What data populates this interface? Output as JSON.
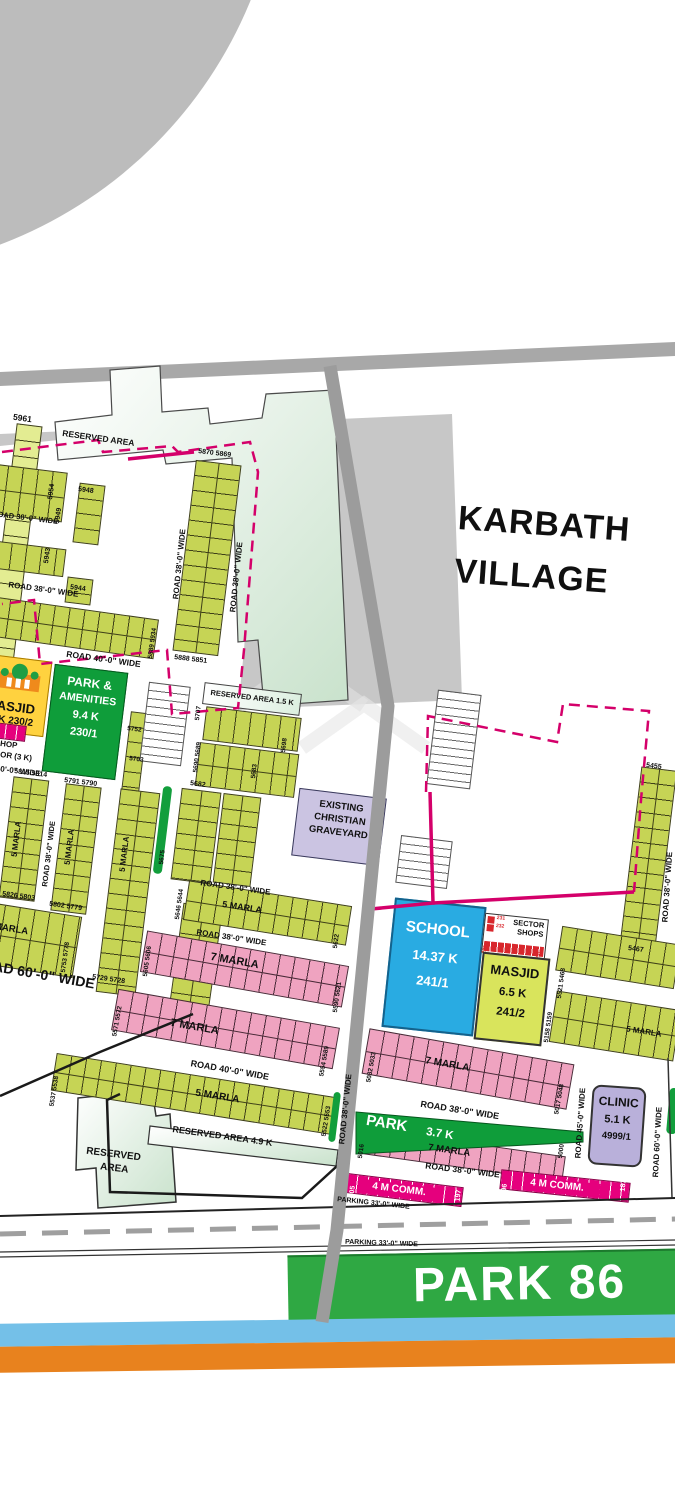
{
  "village": {
    "l1": "KARBATH",
    "l2": "VILLAGE"
  },
  "roads": {
    "r38": "ROAD 38'-0\" WIDE",
    "r40": "ROAD 40'-0\" WIDE",
    "r45": "ROAD 45'-0\" WIDE",
    "r60": "ROAD 60'-0\" WIDE",
    "parking": "PARKING 33'-0\" WIDE"
  },
  "marla": {
    "m5": "5 MARLA",
    "m7": "7 MARLA"
  },
  "comm": {
    "label": "4 M COMM."
  },
  "areas": {
    "reserved": "RESERVED AREA",
    "reserved15": "RESERVED AREA 1.5 K",
    "reserved49": "RESERVED AREA 4.9 K",
    "res_l1": "RESERVED",
    "res_l2": "AREA",
    "gy1": "EXISTING",
    "gy2": "CHRISTIAN",
    "gy3": "GRAVEYARD",
    "pa1": "PARK &",
    "pa2": "AMENITIES",
    "pa3": "9.4 K",
    "pa4": "230/1",
    "ml_name": "MASJID",
    "ml_detail": "K 230/2",
    "shop1": "HOP",
    "shop2": "OR (3 K)",
    "sch1": "SCHOOL",
    "sch2": "14.37 K",
    "sch3": "241/1",
    "ss1": "SECTOR",
    "ss2": "SHOPS",
    "mj1": "MASJID",
    "mj2": "6.5 K",
    "mj3": "241/2",
    "cl1": "CLINIC",
    "cl2": "5.1 K",
    "cl3": "4999/1",
    "p37n": "PARK",
    "p37s": "3.7 K",
    "park86": "PARK 86"
  },
  "plots": {
    "p5961": "5961",
    "p5954": "5954",
    "p5949": "5949",
    "p5948": "5948",
    "p5943": "5943",
    "p5944": "5944",
    "p5870": "5870 5869",
    "p5888": "5888 5851",
    "p5889": "5889 5934",
    "p5815": "5815 5814",
    "p5791": "5791 5790",
    "p5826": "5826 5803",
    "p5802": "5802 5779",
    "p5753": "5753 5778",
    "p5729": "5729 5728",
    "p5707": "5707",
    "p5690": "5690 5689",
    "p5698": "5698",
    "p5683": "5683",
    "p5682": "5682",
    "p5675": "5675",
    "p5752": "5752",
    "p5703": "5703",
    "p5646": "5646 5644",
    "p5622": "5622",
    "p5605": "5605 5606",
    "p5590": "5590 5621",
    "p5571": "5571 5572",
    "p5554": "5554 5589",
    "p5537": "5537 5538",
    "p5522": "5522 5553",
    "p5455": "5455",
    "p5467": "5467",
    "p5521": "5521 5468",
    "p5158": "5158 5159",
    "p5032": "5032 5033",
    "p5017": "5017 5048",
    "p5016": "5016",
    "p5000": "5000",
    "c205": "205",
    "c197": "197",
    "c196": "196",
    "c187": "187",
    "s231": "231",
    "s232": "232",
    "s230": "230",
    "s201": "201"
  },
  "colors": {
    "olive": "#c6d455",
    "pink": "#efa3c0",
    "magenta": "#e5007d",
    "park_green": "#16a03c",
    "school_blue": "#29abe2",
    "clinic_purple": "#b9b0da",
    "boundary_pink": "#d4006a",
    "band_blue": "#74c0e8",
    "band_orange": "#e8821e"
  }
}
